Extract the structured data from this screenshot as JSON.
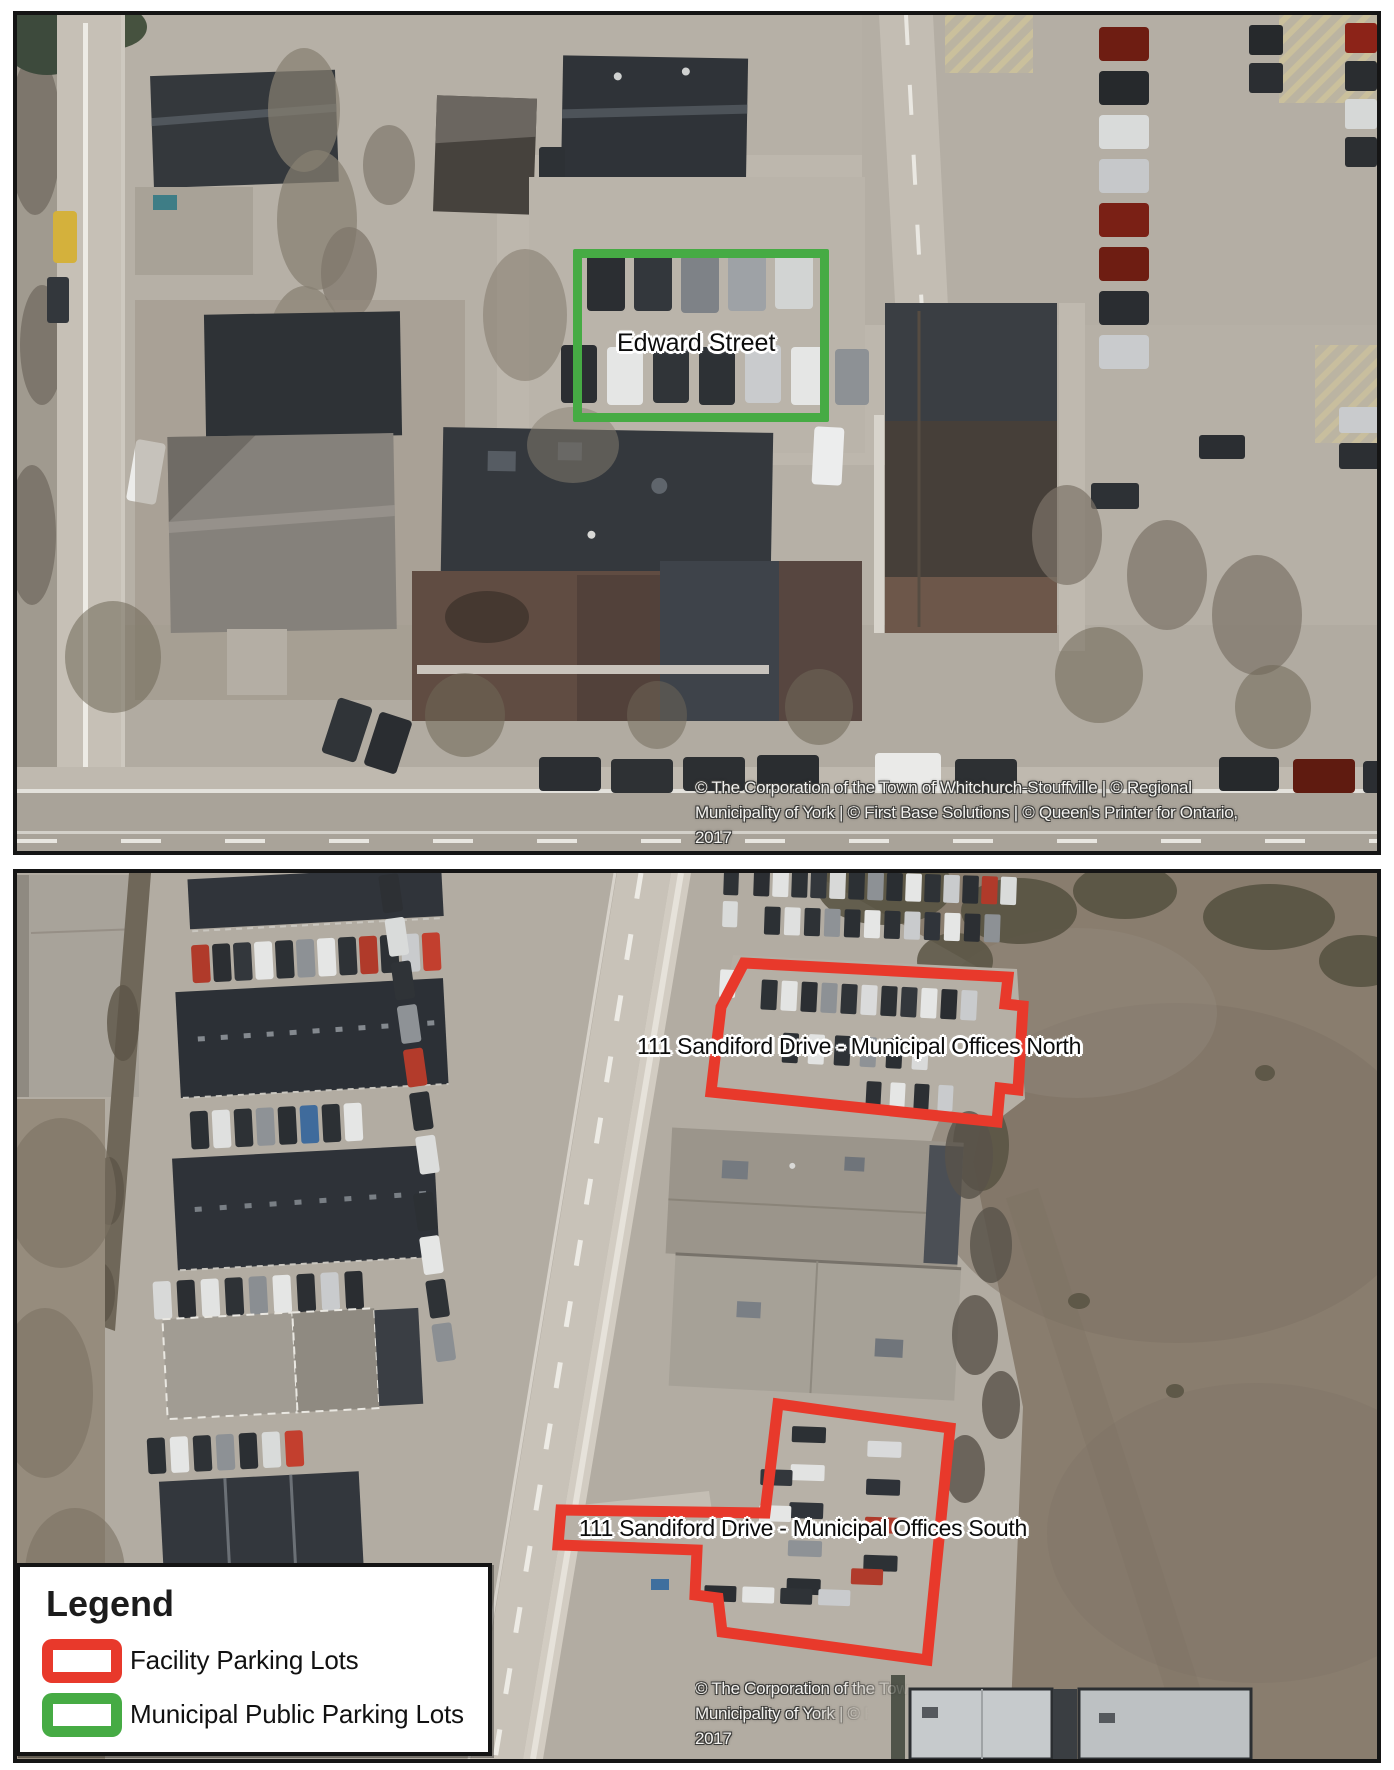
{
  "maps": {
    "top": {
      "description": "Aerial photo of downtown block with municipal public parking lot",
      "parking_label": "Edward Street",
      "copyright": [
        "© The Corporation of the Town of Whitchurch-Stouffville | © Regional",
        "Municipality of York | © First Base Solutions | © Queen's Printer for Ontario,",
        "2017"
      ]
    },
    "bottom": {
      "description": "Aerial photo of Sandiford Drive with municipal office facility parking lots",
      "north_label": "111 Sandiford Drive - Municipal Offices North",
      "south_label": "111 Sandiford Drive - Municipal Offices South",
      "copyright": [
        "© The Corporation of the Town",
        "Municipality of York | © F",
        "2017"
      ]
    }
  },
  "legend": {
    "title": "Legend",
    "items": [
      {
        "label": "Facility Parking Lots",
        "swatch_color": "#e8392b"
      },
      {
        "label": "Municipal Public Parking Lots",
        "swatch_color": "#46ab44"
      }
    ]
  },
  "colors": {
    "facility_parking_outline": "#e8392b",
    "municipal_parking_outline": "#46ab44"
  }
}
